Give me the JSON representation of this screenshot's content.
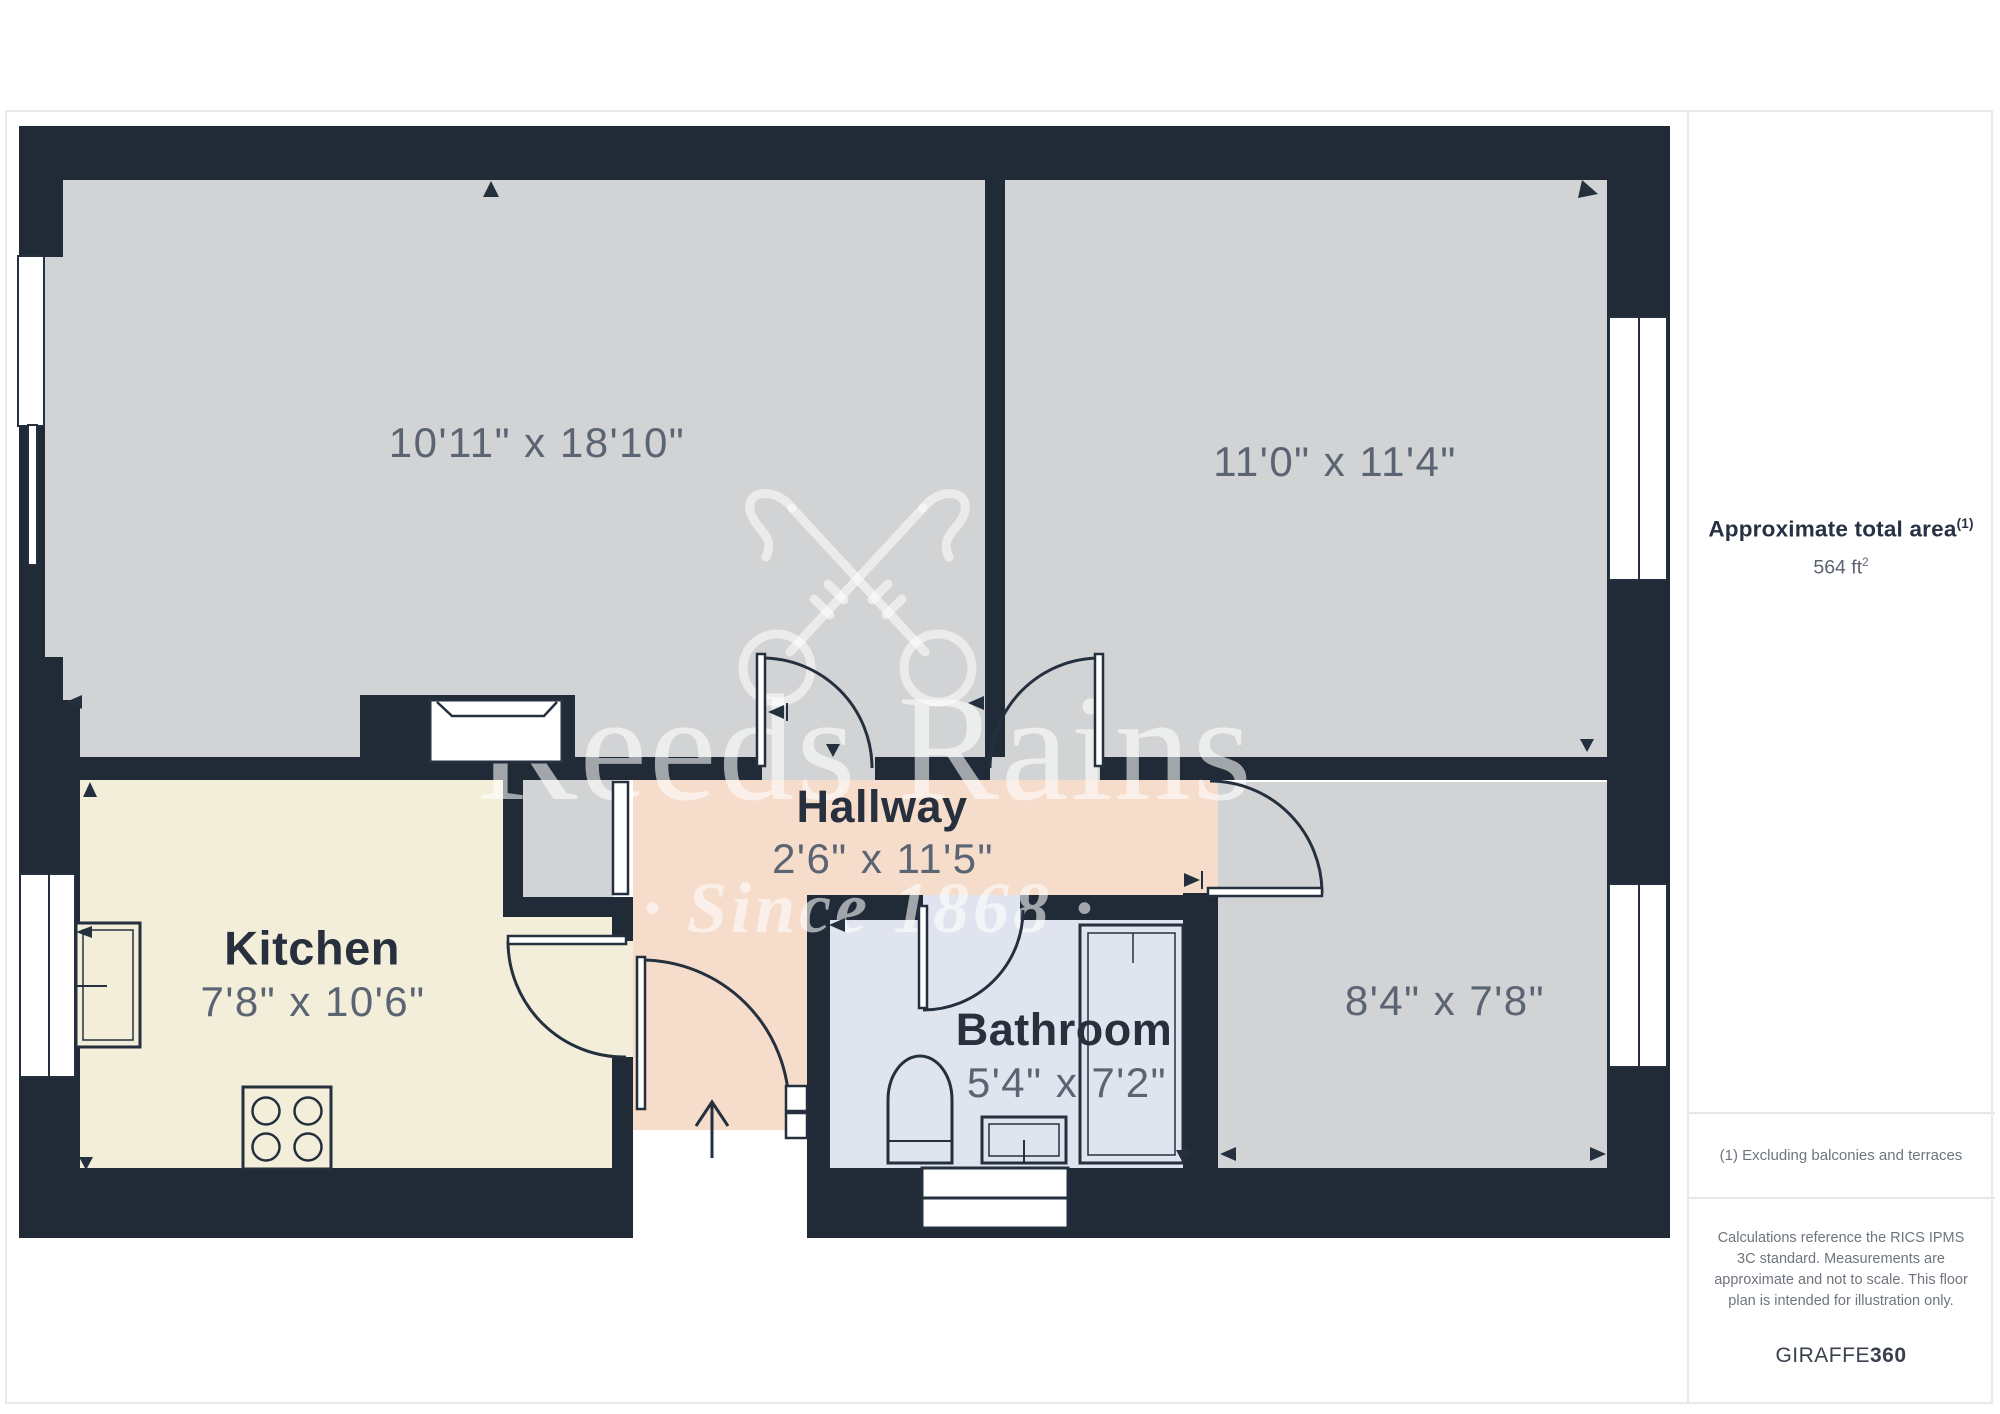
{
  "watermark": {
    "brand": "Reeds Rains",
    "tagline": "· Since 1868 ·",
    "logo": "crossed-keys-icon"
  },
  "rooms": {
    "living_room": {
      "dims": "10'11\" x 18'10\""
    },
    "bedroom_1": {
      "dims": "11'0\" x 11'4\""
    },
    "kitchen": {
      "name": "Kitchen",
      "dims": "7'8\" x 10'6\""
    },
    "hallway": {
      "name": "Hallway",
      "dims": "2'6\" x 11'5\""
    },
    "bathroom": {
      "name": "Bathroom",
      "dims": "5'4\" x 7'2\""
    },
    "bedroom_2": {
      "dims": "8'4\" x 7'8\""
    }
  },
  "sidebar": {
    "area_label": "Approximate total area",
    "area_label_sup": "(1)",
    "area_value": "564 ft",
    "area_value_sup": "2",
    "footnote": "(1) Excluding balconies and terraces",
    "disclaimer": "Calculations reference the RICS IPMS 3C standard. Measurements are approximate and not to scale. This floor plan is intended for illustration only.",
    "brand_name": "GIRAFFE",
    "brand_suffix": "360"
  },
  "colors": {
    "wall": "#212b38",
    "room_gray": "#d2d3d4",
    "kitchen": "#f2eed9",
    "hallway": "#f6dcca",
    "bathroom": "#e0e4ef",
    "label": "#28303e",
    "dims": "#5b6472"
  }
}
